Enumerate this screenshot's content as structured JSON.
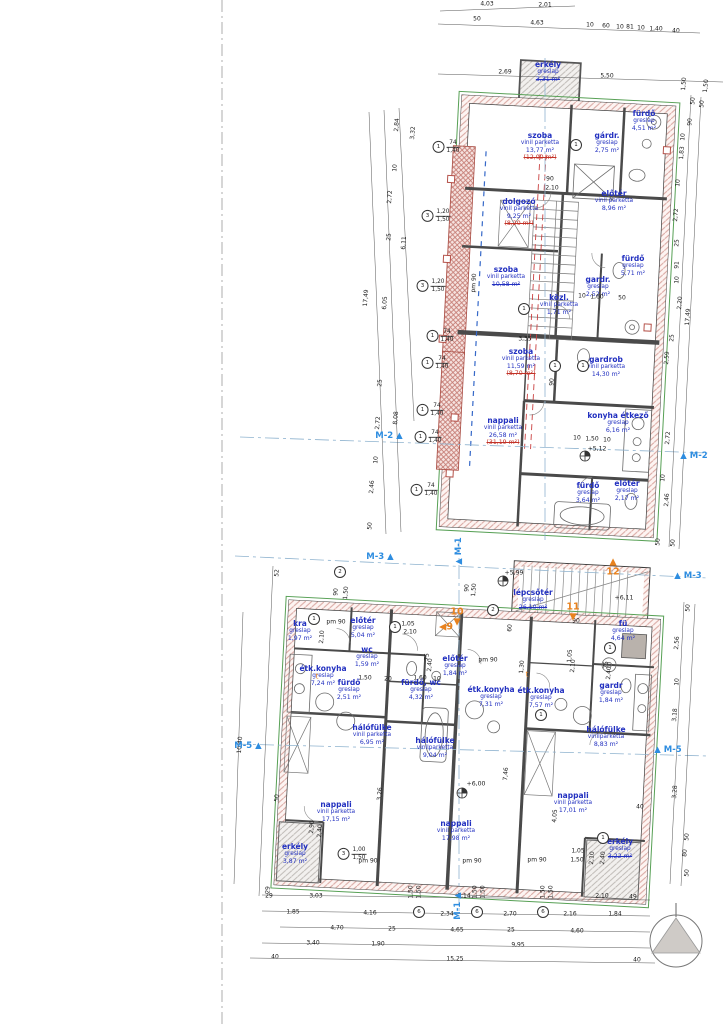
{
  "rooms": [
    {
      "name": "erkély",
      "mat": "greslap",
      "area": "3,31 m²",
      "x": 548,
      "y": 68,
      "struck": true
    },
    {
      "name": "szoba",
      "mat": "vinil parketta",
      "area": "13,77 m²",
      "alt": "(12,00 m²)",
      "x": 540,
      "y": 139
    },
    {
      "name": "fürdő",
      "mat": "greslap",
      "area": "4,51 m²",
      "x": 644,
      "y": 117
    },
    {
      "name": "gárdr.",
      "mat": "greslap",
      "area": "2,75 m²",
      "x": 607,
      "y": 139
    },
    {
      "name": "dolgozó",
      "mat": "vinil parketta",
      "area": "9,25 m²",
      "alt": "(8,20 m²)",
      "x": 519,
      "y": 205
    },
    {
      "name": "előtér",
      "mat": "vinil parketta",
      "area": "8,96 m²",
      "x": 614,
      "y": 197
    },
    {
      "name": "szoba",
      "mat": "vinil parketta",
      "area": "10,58 m²",
      "x": 506,
      "y": 273,
      "struck": true
    },
    {
      "name": "fürdő",
      "mat": "greslap",
      "area": "5,71 m²",
      "x": 633,
      "y": 262
    },
    {
      "name": "gardr.",
      "mat": "greslap",
      "area": "2,52 m²",
      "x": 598,
      "y": 283
    },
    {
      "name": "közl.",
      "mat": "vinil parketta",
      "area": "1,71 m²",
      "x": 559,
      "y": 301
    },
    {
      "name": "szoba",
      "mat": "vinil parketta",
      "area": "11,59 m²",
      "alt": "(8,70 m²)",
      "x": 521,
      "y": 355
    },
    {
      "name": "gardrob",
      "mat": "vinil parketta",
      "area": "14,30 m²",
      "x": 606,
      "y": 363
    },
    {
      "name": "nappali",
      "mat": "vinil parketta",
      "area": "26,58 m²",
      "alt": "(31,19 m²)",
      "x": 503,
      "y": 424
    },
    {
      "name": "konyha étkező",
      "mat": "greslap",
      "area": "6,16 m²",
      "x": 618,
      "y": 419
    },
    {
      "name": "fürdő",
      "mat": "greslap",
      "area": "3,64 m²",
      "x": 588,
      "y": 489
    },
    {
      "name": "előtér",
      "mat": "greslap",
      "area": "2,17 m²",
      "x": 627,
      "y": 487
    },
    {
      "name": "lépcsőtér",
      "mat": "greslap",
      "area": "26,10 m²",
      "x": 533,
      "y": 596,
      "struck": true
    },
    {
      "name": "kra",
      "mat": "greslap",
      "area": "1,97 m²",
      "x": 300,
      "y": 627
    },
    {
      "name": "előtér",
      "mat": "greslap",
      "area": "5,04 m²",
      "x": 363,
      "y": 624
    },
    {
      "name": "wc",
      "mat": "greslap",
      "area": "1,59 m²",
      "x": 367,
      "y": 653
    },
    {
      "name": "étk.konyha",
      "mat": "greslap",
      "area": "7,24 m²",
      "x": 323,
      "y": 672
    },
    {
      "name": "fürdő",
      "mat": "greslap",
      "area": "2,51 m²",
      "x": 349,
      "y": 686
    },
    {
      "name": "fürdő, wc",
      "mat": "greslap",
      "area": "4,32 m²",
      "x": 421,
      "y": 686
    },
    {
      "name": "előtér",
      "mat": "greslap",
      "area": "1,84 m²",
      "x": 455,
      "y": 662
    },
    {
      "name": "étk.konyha",
      "mat": "greslap",
      "area": "7,31 m²",
      "x": 491,
      "y": 693
    },
    {
      "name": "étk.konyha",
      "mat": "greslap",
      "area": "7,57 m²",
      "x": 541,
      "y": 694
    },
    {
      "name": "fü",
      "mat": "greslap",
      "area": "4,64 m²",
      "x": 623,
      "y": 627
    },
    {
      "name": "gardr",
      "mat": "greslap",
      "area": "1,84 m²",
      "x": 611,
      "y": 689
    },
    {
      "name": "hálófülke",
      "mat": "vinil parketta",
      "area": "6,95 m²",
      "x": 372,
      "y": 731
    },
    {
      "name": "hálófülke",
      "mat": "vinilparketta",
      "area": "9,04 m²",
      "x": 435,
      "y": 744
    },
    {
      "name": "hálófülke",
      "mat": "vinilparketta",
      "area": "8,83 m²",
      "x": 606,
      "y": 733
    },
    {
      "name": "nappali",
      "mat": "vinil parketta",
      "area": "17,15 m²",
      "x": 336,
      "y": 808
    },
    {
      "name": "nappali",
      "mat": "vinil parketta",
      "area": "17,98 m²",
      "x": 456,
      "y": 827
    },
    {
      "name": "nappali",
      "mat": "vinil parketta",
      "area": "17,01 m²",
      "x": 573,
      "y": 799
    },
    {
      "name": "erkély",
      "mat": "greslap",
      "area": "3,87 m²",
      "x": 295,
      "y": 850
    },
    {
      "name": "erkély",
      "mat": "greslap",
      "area": "3,22 m²",
      "x": 620,
      "y": 845,
      "struck": true
    }
  ],
  "dims": [
    {
      "t": "4,03",
      "x": 487,
      "y": 4
    },
    {
      "t": "2,01",
      "x": 545,
      "y": 5
    },
    {
      "t": "50",
      "x": 477,
      "y": 19
    },
    {
      "t": "4,63",
      "x": 537,
      "y": 23
    },
    {
      "t": "10",
      "x": 590,
      "y": 25
    },
    {
      "t": "60",
      "x": 606,
      "y": 26
    },
    {
      "t": "10",
      "x": 620,
      "y": 27
    },
    {
      "t": "81",
      "x": 630,
      "y": 27
    },
    {
      "t": "10",
      "x": 641,
      "y": 28
    },
    {
      "t": "1,40",
      "x": 656,
      "y": 29
    },
    {
      "t": "40",
      "x": 676,
      "y": 31
    },
    {
      "t": "2,69",
      "x": 505,
      "y": 72
    },
    {
      "t": "5,50",
      "x": 607,
      "y": 76
    },
    {
      "t": "1,50",
      "x": 706,
      "y": 86,
      "r": -84
    },
    {
      "t": "2,84",
      "x": 397,
      "y": 125,
      "r": -86
    },
    {
      "t": "3,32",
      "x": 413,
      "y": 133,
      "r": -86
    },
    {
      "t": "10",
      "x": 395,
      "y": 168,
      "r": -86
    },
    {
      "t": "2,72",
      "x": 390,
      "y": 197,
      "r": -86
    },
    {
      "t": "25",
      "x": 389,
      "y": 237,
      "r": -86
    },
    {
      "t": "6,11",
      "x": 404,
      "y": 243,
      "r": -86
    },
    {
      "t": "17,49",
      "x": 366,
      "y": 298,
      "r": -86
    },
    {
      "t": "6,05",
      "x": 385,
      "y": 303,
      "r": -86
    },
    {
      "t": "25",
      "x": 380,
      "y": 383,
      "r": -86
    },
    {
      "t": "8,08",
      "x": 396,
      "y": 418,
      "r": -86
    },
    {
      "t": "2,72",
      "x": 378,
      "y": 423,
      "r": -86
    },
    {
      "t": "10",
      "x": 376,
      "y": 460,
      "r": -86
    },
    {
      "t": "2,46",
      "x": 372,
      "y": 487,
      "r": -86
    },
    {
      "t": "50",
      "x": 370,
      "y": 526,
      "r": -86
    },
    {
      "t": "1,50",
      "x": 684,
      "y": 84,
      "r": -86
    },
    {
      "t": "50",
      "x": 693,
      "y": 101,
      "r": -86
    },
    {
      "t": "50",
      "x": 702,
      "y": 104,
      "r": -86
    },
    {
      "t": "90",
      "x": 690,
      "y": 122,
      "r": -86
    },
    {
      "t": "10",
      "x": 683,
      "y": 137,
      "r": -86
    },
    {
      "t": "1,83",
      "x": 682,
      "y": 153,
      "r": -86
    },
    {
      "t": "10",
      "x": 678,
      "y": 183,
      "r": -86
    },
    {
      "t": "2,72",
      "x": 676,
      "y": 215,
      "r": -86
    },
    {
      "t": "25",
      "x": 677,
      "y": 243,
      "r": -86
    },
    {
      "t": "91",
      "x": 677,
      "y": 265,
      "r": -86
    },
    {
      "t": "10",
      "x": 677,
      "y": 280,
      "r": -86
    },
    {
      "t": "2,20",
      "x": 680,
      "y": 303,
      "r": -86
    },
    {
      "t": "17,49",
      "x": 688,
      "y": 317,
      "r": -86
    },
    {
      "t": "25",
      "x": 672,
      "y": 338,
      "r": -86
    },
    {
      "t": "2,59",
      "x": 667,
      "y": 358,
      "r": -86
    },
    {
      "t": "2,72",
      "x": 668,
      "y": 438,
      "r": -86
    },
    {
      "t": "10",
      "x": 663,
      "y": 478,
      "r": -86
    },
    {
      "t": "2,46",
      "x": 667,
      "y": 500,
      "r": -86
    },
    {
      "t": "50",
      "x": 658,
      "y": 542,
      "r": -86
    },
    {
      "t": "50",
      "x": 673,
      "y": 543,
      "r": -86
    },
    {
      "t": "50",
      "x": 688,
      "y": 608,
      "r": -86
    },
    {
      "t": "2,56",
      "x": 677,
      "y": 643,
      "r": -86
    },
    {
      "t": "10",
      "x": 677,
      "y": 682,
      "r": -86
    },
    {
      "t": "3,18",
      "x": 675,
      "y": 715,
      "r": -86
    },
    {
      "t": "3,28",
      "x": 675,
      "y": 792,
      "r": -86
    },
    {
      "t": "50",
      "x": 687,
      "y": 837,
      "r": -86
    },
    {
      "t": "80",
      "x": 685,
      "y": 853,
      "r": -86
    },
    {
      "t": "50",
      "x": 687,
      "y": 873,
      "r": -86
    },
    {
      "t": "52",
      "x": 277,
      "y": 573,
      "r": -86
    },
    {
      "t": "10,40",
      "x": 240,
      "y": 745,
      "r": -86
    },
    {
      "t": "50",
      "x": 277,
      "y": 798,
      "r": -86
    },
    {
      "t": "29",
      "x": 268,
      "y": 890,
      "r": -86
    },
    {
      "t": "29",
      "x": 269,
      "y": 896
    },
    {
      "t": "3,03",
      "x": 316,
      "y": 896
    },
    {
      "t": "1,50",
      "x": 411,
      "y": 892,
      "r": -90
    },
    {
      "t": "1,50",
      "x": 419,
      "y": 892,
      "r": -90
    },
    {
      "t": "9,14",
      "x": 464,
      "y": 896
    },
    {
      "t": "1,50",
      "x": 475,
      "y": 892,
      "r": -90
    },
    {
      "t": "1,50",
      "x": 483,
      "y": 892,
      "r": -90
    },
    {
      "t": "1,50",
      "x": 543,
      "y": 892,
      "r": -90
    },
    {
      "t": "1,50",
      "x": 551,
      "y": 892,
      "r": -90
    },
    {
      "t": "2,10",
      "x": 602,
      "y": 896
    },
    {
      "t": "49",
      "x": 633,
      "y": 897
    },
    {
      "t": "1,85",
      "x": 293,
      "y": 912
    },
    {
      "t": "4,16",
      "x": 370,
      "y": 913
    },
    {
      "t": "2,34",
      "x": 447,
      "y": 914
    },
    {
      "t": "2,70",
      "x": 510,
      "y": 914
    },
    {
      "t": "2,16",
      "x": 570,
      "y": 914
    },
    {
      "t": "1,84",
      "x": 615,
      "y": 914
    },
    {
      "t": "4,70",
      "x": 337,
      "y": 928
    },
    {
      "t": "25",
      "x": 392,
      "y": 929
    },
    {
      "t": "4,65",
      "x": 457,
      "y": 930
    },
    {
      "t": "25",
      "x": 511,
      "y": 930
    },
    {
      "t": "4,60",
      "x": 577,
      "y": 931
    },
    {
      "t": "3,40",
      "x": 313,
      "y": 943
    },
    {
      "t": "1,90",
      "x": 378,
      "y": 944
    },
    {
      "t": "9,95",
      "x": 518,
      "y": 945
    },
    {
      "t": "40",
      "x": 275,
      "y": 957
    },
    {
      "t": "15,25",
      "x": 455,
      "y": 959
    },
    {
      "t": "40",
      "x": 637,
      "y": 960
    },
    {
      "t": "90",
      "x": 550,
      "y": 179
    },
    {
      "t": "2,10",
      "x": 552,
      "y": 188
    },
    {
      "t": "pm 90",
      "x": 474,
      "y": 283,
      "r": -86
    },
    {
      "t": "3,35",
      "x": 525,
      "y": 339
    },
    {
      "t": "90",
      "x": 552,
      "y": 382,
      "r": -86
    },
    {
      "t": "10",
      "x": 582,
      "y": 296
    },
    {
      "t": "1,60",
      "x": 597,
      "y": 297
    },
    {
      "t": "50",
      "x": 622,
      "y": 298
    },
    {
      "t": "10",
      "x": 577,
      "y": 438
    },
    {
      "t": "1,50",
      "x": 592,
      "y": 439
    },
    {
      "t": "10",
      "x": 607,
      "y": 440
    },
    {
      "t": "pm 90",
      "x": 336,
      "y": 622
    },
    {
      "t": "90",
      "x": 467,
      "y": 588,
      "r": -86
    },
    {
      "t": "1,50",
      "x": 474,
      "y": 590,
      "r": -86
    },
    {
      "t": "90",
      "x": 336,
      "y": 592,
      "r": -86
    },
    {
      "t": "1,50",
      "x": 346,
      "y": 593,
      "r": -86
    },
    {
      "t": "1,05",
      "x": 408,
      "y": 624
    },
    {
      "t": "2,10",
      "x": 410,
      "y": 632
    },
    {
      "t": "2,10",
      "x": 322,
      "y": 637,
      "r": -86
    },
    {
      "t": "75",
      "x": 427,
      "y": 657,
      "r": -86
    },
    {
      "t": "2,40",
      "x": 430,
      "y": 665,
      "r": -86
    },
    {
      "t": "1,50",
      "x": 365,
      "y": 678
    },
    {
      "t": "20",
      "x": 388,
      "y": 679
    },
    {
      "t": "1,60",
      "x": 420,
      "y": 678
    },
    {
      "t": "10",
      "x": 437,
      "y": 679
    },
    {
      "t": "60",
      "x": 510,
      "y": 628,
      "r": -86
    },
    {
      "t": "90",
      "x": 576,
      "y": 621
    },
    {
      "t": "pm 90",
      "x": 488,
      "y": 660
    },
    {
      "t": "1,05",
      "x": 570,
      "y": 656,
      "r": -86
    },
    {
      "t": "2,10",
      "x": 573,
      "y": 666,
      "r": -86
    },
    {
      "t": "75",
      "x": 606,
      "y": 665,
      "r": -86
    },
    {
      "t": "2,40",
      "x": 609,
      "y": 673,
      "r": -86
    },
    {
      "t": "1,30",
      "x": 522,
      "y": 667,
      "r": -86
    },
    {
      "t": "7,46",
      "x": 506,
      "y": 774,
      "r": -86
    },
    {
      "t": "3,26",
      "x": 380,
      "y": 794,
      "r": -86
    },
    {
      "t": "4,05",
      "x": 555,
      "y": 816,
      "r": -86
    },
    {
      "t": "2,90",
      "x": 312,
      "y": 827,
      "r": -86
    },
    {
      "t": "2,40",
      "x": 320,
      "y": 831,
      "r": -86
    },
    {
      "t": "1,05",
      "x": 578,
      "y": 851
    },
    {
      "t": "1,50",
      "x": 577,
      "y": 860
    },
    {
      "t": "2,10",
      "x": 592,
      "y": 858,
      "r": -86
    },
    {
      "t": "2,40",
      "x": 603,
      "y": 858,
      "r": -86
    },
    {
      "t": "40",
      "x": 640,
      "y": 807
    },
    {
      "t": "pm 90",
      "x": 368,
      "y": 861
    },
    {
      "t": "pm 90",
      "x": 472,
      "y": 861
    },
    {
      "t": "pm 90",
      "x": 537,
      "y": 860
    }
  ],
  "tags": [
    {
      "n": "1",
      "a": "74",
      "b": "1,40",
      "x": 446,
      "y": 147
    },
    {
      "n": "3",
      "a": "1,20",
      "b": "1,50",
      "x": 436,
      "y": 216
    },
    {
      "n": "3",
      "a": "1,20",
      "b": "1,50",
      "x": 431,
      "y": 286
    },
    {
      "n": "1",
      "a": "74",
      "b": "1,40",
      "x": 440,
      "y": 336
    },
    {
      "n": "1",
      "a": "74",
      "b": "1,40",
      "x": 435,
      "y": 363
    },
    {
      "n": "1",
      "a": "74",
      "b": "1,40",
      "x": 430,
      "y": 410
    },
    {
      "n": "1",
      "a": "74",
      "b": "1,40",
      "x": 428,
      "y": 437
    },
    {
      "n": "1",
      "a": "74",
      "b": "1,40",
      "x": 424,
      "y": 490
    },
    {
      "n": "3",
      "a": "1,00",
      "b": "1,50",
      "x": 352,
      "y": 854
    }
  ],
  "circles": [
    {
      "n": "1",
      "x": 576,
      "y": 145
    },
    {
      "n": "1",
      "x": 524,
      "y": 309
    },
    {
      "n": "1",
      "x": 555,
      "y": 366
    },
    {
      "n": "1",
      "x": 583,
      "y": 366
    },
    {
      "n": "2",
      "x": 340,
      "y": 572
    },
    {
      "n": "2",
      "x": 493,
      "y": 610
    },
    {
      "n": "1",
      "x": 314,
      "y": 619
    },
    {
      "n": "1",
      "x": 395,
      "y": 627
    },
    {
      "n": "1",
      "x": 610,
      "y": 648
    },
    {
      "n": "1",
      "x": 541,
      "y": 715
    },
    {
      "n": "1",
      "x": 603,
      "y": 838
    },
    {
      "n": "6",
      "x": 419,
      "y": 912
    },
    {
      "n": "6",
      "x": 477,
      "y": 912
    },
    {
      "n": "6",
      "x": 543,
      "y": 912
    }
  ],
  "sections": [
    {
      "t": "M-2",
      "post": " ▲",
      "x": 389,
      "y": 436
    },
    {
      "pre": "▲ ",
      "t": "M-2",
      "x": 694,
      "y": 456
    },
    {
      "t": "M-3",
      "post": " ▲",
      "x": 380,
      "y": 557
    },
    {
      "pre": "▲ ",
      "t": "M-3",
      "x": 688,
      "y": 576
    },
    {
      "t": "M-5",
      "post": " ▲",
      "x": 248,
      "y": 746
    },
    {
      "pre": "▲ ",
      "t": "M-5",
      "x": 668,
      "y": 750
    },
    {
      "pre": "▲ ",
      "t": "M-1",
      "x": 459,
      "y": 551,
      "r": -90
    },
    {
      "t": "M-1",
      "post": " ▲",
      "x": 458,
      "y": 906,
      "r": -90
    }
  ],
  "orange_markers": [
    {
      "t": "10",
      "post": "▼",
      "x": 457,
      "y": 617,
      "cls": "col"
    },
    {
      "pre": "◀",
      "t": "9",
      "x": 446,
      "y": 627
    },
    {
      "t": "11",
      "post": "▼",
      "x": 573,
      "y": 612,
      "cls": "col"
    },
    {
      "pre": "▲",
      "t": "12",
      "x": 613,
      "y": 567,
      "cls": "col"
    },
    {
      "t": "t",
      "x": 317,
      "y": 677,
      "cls": "sm"
    },
    {
      "t": "t",
      "x": 527,
      "y": 675,
      "cls": "sm"
    }
  ],
  "elevations": [
    {
      "t": "+5,12",
      "x": 597,
      "y": 449
    },
    {
      "t": "+5,99",
      "x": 514,
      "y": 573
    },
    {
      "t": "+6,11",
      "x": 624,
      "y": 598
    },
    {
      "t": "+6,00",
      "x": 476,
      "y": 784
    }
  ]
}
